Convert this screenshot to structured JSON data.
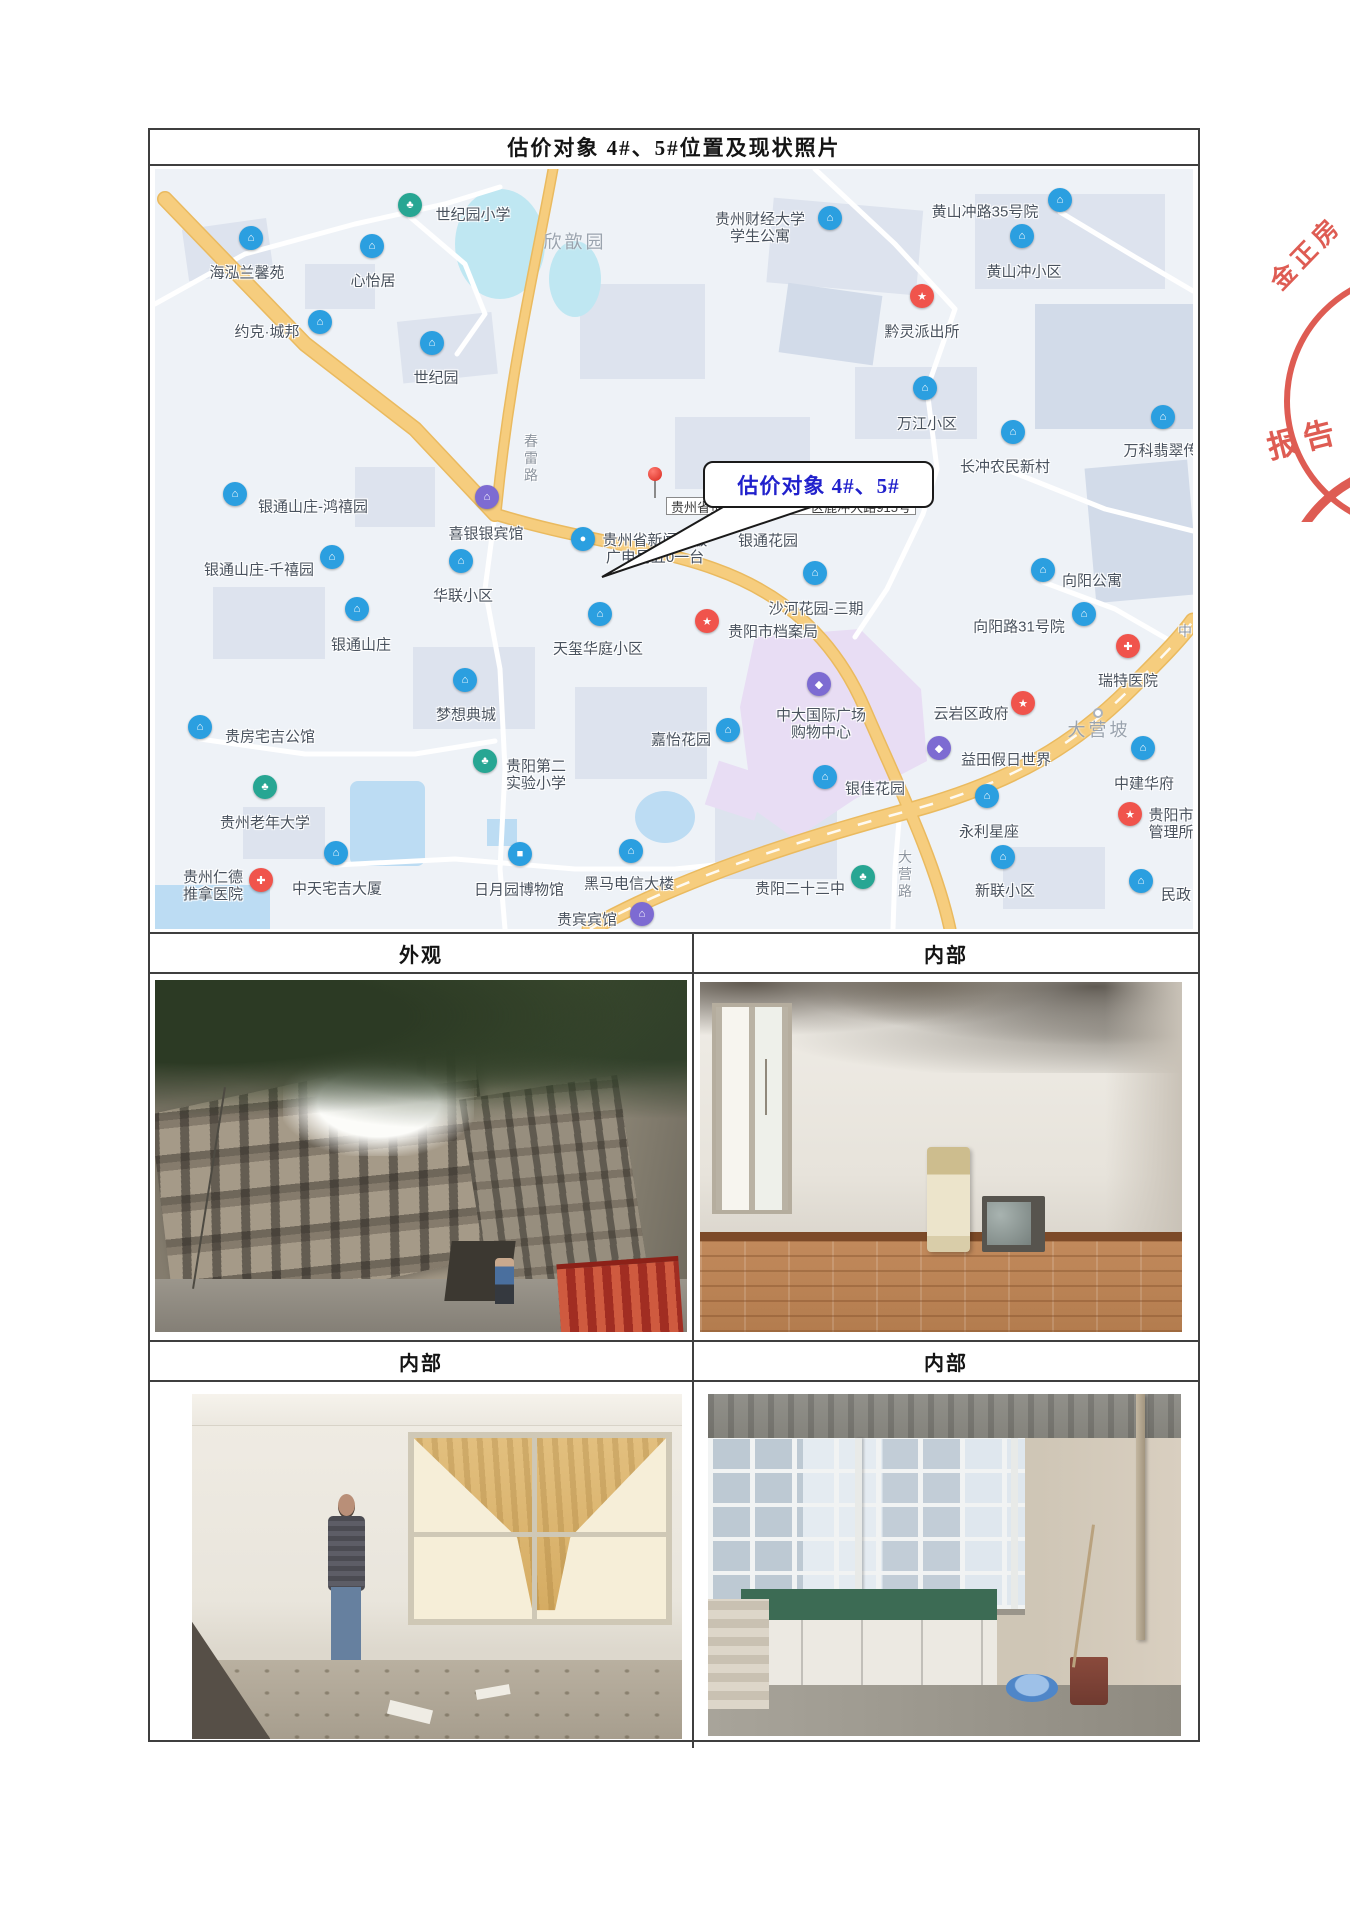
{
  "doc": {
    "title": "估价对象 4#、5#位置及现状照片"
  },
  "photo_grid": {
    "headers_row1": [
      "外观",
      "内部"
    ],
    "headers_row2": [
      "内部",
      "内部"
    ]
  },
  "stamp": {
    "line1": "金正房",
    "line2": "报告",
    "color": "#dc4f45"
  },
  "map": {
    "callout_text": "估价对象 4#、5#",
    "address": {
      "left": "贵州省贵",
      "right": "区鹿冲大路915号"
    },
    "colors": {
      "pin_blue": "#2b9fe0",
      "pin_green": "#27a693",
      "pin_red": "#f0544c",
      "pin_purple": "#7d6bd2",
      "road_yellow": "#f6cd7e"
    },
    "area_labels": [
      {
        "x": 420,
        "y": 72,
        "text": "欣歆园"
      },
      {
        "x": 944,
        "y": 560,
        "text": "大营坡",
        "dot": true
      }
    ],
    "road_labels": [
      {
        "x": 376,
        "y": 290,
        "text": "春雷路",
        "vertical": true
      },
      {
        "x": 750,
        "y": 706,
        "text": "大营路",
        "vertical": true
      },
      {
        "x": 1030,
        "y": 462,
        "text": "中",
        "vertical": false
      }
    ],
    "pois": [
      {
        "x": 255,
        "y": 48,
        "type": "green",
        "glyph": "♣",
        "label": {
          "x": 318,
          "y": 47,
          "lines": [
            "世纪园小学"
          ]
        }
      },
      {
        "x": 96,
        "y": 81,
        "type": "blue",
        "glyph": "⌂",
        "label": {
          "x": 92,
          "y": 105,
          "lines": [
            "海泓兰馨苑"
          ]
        }
      },
      {
        "x": 217,
        "y": 89,
        "type": "blue",
        "glyph": "⌂",
        "label": {
          "x": 218,
          "y": 113,
          "lines": [
            "心怡居"
          ]
        }
      },
      {
        "x": 165,
        "y": 165,
        "type": "blue",
        "glyph": "⌂",
        "label": {
          "x": 112,
          "y": 164,
          "lines": [
            "约克·城邦"
          ]
        }
      },
      {
        "x": 277,
        "y": 186,
        "type": "blue",
        "glyph": "⌂",
        "label": {
          "x": 281,
          "y": 210,
          "lines": [
            "世纪园"
          ]
        }
      },
      {
        "x": 675,
        "y": 61,
        "type": "blue",
        "glyph": "⌂",
        "label": {
          "x": 605,
          "y": 60,
          "lines": [
            "贵州财经大学",
            "学生公寓"
          ]
        }
      },
      {
        "x": 905,
        "y": 43,
        "type": "blue",
        "glyph": "⌂",
        "label": {
          "x": 830,
          "y": 44,
          "lines": [
            "黄山冲路35号院"
          ]
        }
      },
      {
        "x": 867,
        "y": 79,
        "type": "blue",
        "glyph": "⌂",
        "label": {
          "x": 869,
          "y": 104,
          "lines": [
            "黄山冲小区"
          ]
        }
      },
      {
        "x": 767,
        "y": 139,
        "type": "red",
        "glyph": "★",
        "label": {
          "x": 767,
          "y": 164,
          "lines": [
            "黔灵派出所"
          ]
        }
      },
      {
        "x": 770,
        "y": 231,
        "type": "blue",
        "glyph": "⌂",
        "label": {
          "x": 772,
          "y": 256,
          "lines": [
            "万江小区"
          ]
        }
      },
      {
        "x": 858,
        "y": 275,
        "type": "blue",
        "glyph": "⌂",
        "label": {
          "x": 850,
          "y": 299,
          "lines": [
            "长冲农民新村"
          ]
        }
      },
      {
        "x": 1008,
        "y": 260,
        "type": "blue",
        "glyph": "⌂",
        "label": {
          "x": 1006,
          "y": 283,
          "lines": [
            "万科翡翠传"
          ]
        }
      },
      {
        "x": 80,
        "y": 337,
        "type": "blue",
        "glyph": "⌂",
        "label": {
          "x": 158,
          "y": 339,
          "lines": [
            "银通山庄-鸿禧园"
          ]
        }
      },
      {
        "x": 177,
        "y": 400,
        "type": "blue",
        "glyph": "⌂",
        "label": {
          "x": 104,
          "y": 402,
          "lines": [
            "银通山庄-千禧园"
          ]
        }
      },
      {
        "x": 332,
        "y": 340,
        "type": "purple",
        "glyph": "⌂",
        "label": {
          "x": 331,
          "y": 366,
          "lines": [
            "喜银银宾馆"
          ]
        }
      },
      {
        "x": 306,
        "y": 404,
        "type": "blue",
        "glyph": "⌂",
        "label": {
          "x": 308,
          "y": 428,
          "lines": [
            "华联小区"
          ]
        }
      },
      {
        "x": 202,
        "y": 452,
        "type": "blue",
        "glyph": "⌂",
        "label": {
          "x": 206,
          "y": 477,
          "lines": [
            "银通山庄"
          ]
        }
      },
      {
        "x": 445,
        "y": 457,
        "type": "blue",
        "glyph": "⌂",
        "label": {
          "x": 443,
          "y": 481,
          "lines": [
            "天玺华庭小区"
          ]
        }
      },
      {
        "x": 310,
        "y": 523,
        "type": "blue",
        "glyph": "⌂",
        "label": {
          "x": 311,
          "y": 547,
          "lines": [
            "梦想典城"
          ]
        }
      },
      {
        "x": 45,
        "y": 570,
        "type": "blue",
        "glyph": "⌂",
        "label": {
          "x": 115,
          "y": 569,
          "lines": [
            "贵房宅吉公馆"
          ]
        }
      },
      {
        "x": 573,
        "y": 573,
        "type": "blue",
        "glyph": "⌂",
        "label": {
          "x": 526,
          "y": 572,
          "lines": [
            "嘉怡花园"
          ]
        }
      },
      {
        "x": 330,
        "y": 604,
        "type": "green",
        "glyph": "♣",
        "label": {
          "x": 381,
          "y": 607,
          "lines": [
            "贵阳第二",
            "实验小学"
          ]
        }
      },
      {
        "x": 110,
        "y": 630,
        "type": "green",
        "glyph": "♣",
        "label": {
          "x": 110,
          "y": 655,
          "lines": [
            "贵州老年大学"
          ]
        }
      },
      {
        "x": 106,
        "y": 723,
        "type": "red",
        "glyph": "✚",
        "label": {
          "x": 58,
          "y": 718,
          "lines": [
            "贵州仁德",
            "推拿医院"
          ]
        }
      },
      {
        "x": 181,
        "y": 696,
        "type": "blue",
        "glyph": "⌂",
        "label": {
          "x": 182,
          "y": 721,
          "lines": [
            "中天宅吉大厦"
          ]
        }
      },
      {
        "x": 365,
        "y": 697,
        "type": "blue",
        "glyph": "■",
        "label": {
          "x": 364,
          "y": 722,
          "lines": [
            "日月园博物馆"
          ]
        }
      },
      {
        "x": 476,
        "y": 694,
        "type": "blue",
        "glyph": "⌂",
        "label": {
          "x": 474,
          "y": 716,
          "lines": [
            "黑马电信大楼"
          ]
        }
      },
      {
        "x": 487,
        "y": 757,
        "type": "purple",
        "glyph": "⌂",
        "label": {
          "x": 432,
          "y": 752,
          "lines": [
            "贵宾宾馆"
          ]
        }
      },
      {
        "x": 428,
        "y": 382,
        "type": "blue",
        "glyph": "●",
        "label": {
          "x": 500,
          "y": 381,
          "lines": [
            "贵州省新闻出版",
            "广电局五0一台"
          ]
        }
      },
      {
        "x": 612,
        "y": 350,
        "type": "blue",
        "glyph": "⌂",
        "label": {
          "x": 613,
          "y": 373,
          "lines": [
            "银通花园"
          ]
        }
      },
      {
        "x": 660,
        "y": 416,
        "type": "blue",
        "glyph": "⌂",
        "label": {
          "x": 661,
          "y": 441,
          "lines": [
            "沙河花园-三期"
          ]
        }
      },
      {
        "x": 552,
        "y": 464,
        "type": "red",
        "glyph": "★",
        "label": {
          "x": 618,
          "y": 464,
          "lines": [
            "贵阳市档案局"
          ]
        }
      },
      {
        "x": 888,
        "y": 413,
        "type": "blue",
        "glyph": "⌂",
        "label": {
          "x": 937,
          "y": 413,
          "lines": [
            "向阳公寓"
          ]
        }
      },
      {
        "x": 929,
        "y": 457,
        "type": "blue",
        "glyph": "⌂",
        "label": {
          "x": 864,
          "y": 459,
          "lines": [
            "向阳路31号院"
          ]
        }
      },
      {
        "x": 973,
        "y": 489,
        "type": "red",
        "glyph": "✚",
        "label": {
          "x": 973,
          "y": 513,
          "lines": [
            "瑞特医院"
          ]
        }
      },
      {
        "x": 868,
        "y": 546,
        "type": "red",
        "glyph": "★",
        "label": {
          "x": 816,
          "y": 546,
          "lines": [
            "云岩区政府"
          ]
        }
      },
      {
        "x": 784,
        "y": 591,
        "type": "purple",
        "glyph": "◆",
        "label": {
          "x": 851,
          "y": 592,
          "lines": [
            "益田假日世界"
          ]
        }
      },
      {
        "x": 664,
        "y": 527,
        "type": "purple",
        "glyph": "◆",
        "label": {
          "x": 666,
          "y": 556,
          "lines": [
            "中大国际广场",
            "购物中心"
          ]
        }
      },
      {
        "x": 670,
        "y": 620,
        "type": "blue",
        "glyph": "⌂",
        "label": {
          "x": 720,
          "y": 621,
          "lines": [
            "银佳花园"
          ]
        }
      },
      {
        "x": 988,
        "y": 591,
        "type": "blue",
        "glyph": "⌂",
        "label": {
          "x": 989,
          "y": 616,
          "lines": [
            "中建华府"
          ]
        }
      },
      {
        "x": 832,
        "y": 639,
        "type": "blue",
        "glyph": "⌂",
        "label": {
          "x": 834,
          "y": 664,
          "lines": [
            "永利星座"
          ]
        }
      },
      {
        "x": 975,
        "y": 657,
        "type": "red",
        "glyph": "★",
        "label": {
          "x": 1016,
          "y": 656,
          "lines": [
            "贵阳市",
            "管理所"
          ]
        }
      },
      {
        "x": 708,
        "y": 720,
        "type": "green",
        "glyph": "♣",
        "label": {
          "x": 645,
          "y": 721,
          "lines": [
            "贵阳二十三中"
          ]
        }
      },
      {
        "x": 848,
        "y": 700,
        "type": "blue",
        "glyph": "⌂",
        "label": {
          "x": 850,
          "y": 723,
          "lines": [
            "新联小区"
          ]
        }
      },
      {
        "x": 986,
        "y": 724,
        "type": "blue",
        "glyph": "⌂",
        "label": {
          "x": 1021,
          "y": 727,
          "lines": [
            "民政"
          ]
        }
      }
    ]
  }
}
